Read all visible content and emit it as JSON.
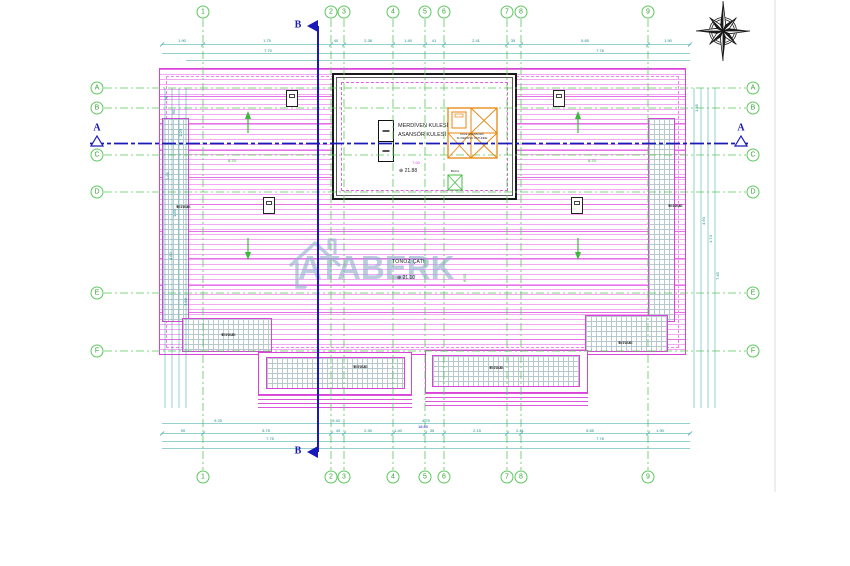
{
  "drawing": {
    "watermark_text": "ATABERK",
    "roof_type_label": "TONOZ ÇATI",
    "roof_level": "21.10",
    "level_symbol": "⊕",
    "tower": {
      "label_line1": "MERDİVEN KULESİ",
      "label_line2": "ASANSÖR KULESİ",
      "level": "21.88",
      "elevator_label_line1": "KULE ASANSÖRÜ",
      "elevator_label_line2": "SU DEPOSU ÜSTÜNDE",
      "shaft_label": "BACA"
    },
    "section_markers": {
      "horizontal": "A",
      "vertical": "B"
    }
  },
  "grid": {
    "columns": [
      {
        "label": "1",
        "x": 203
      },
      {
        "label": "2",
        "x": 331
      },
      {
        "label": "3",
        "x": 344
      },
      {
        "label": "4",
        "x": 393
      },
      {
        "label": "5",
        "x": 425
      },
      {
        "label": "6",
        "x": 444
      },
      {
        "label": "7",
        "x": 507
      },
      {
        "label": "8",
        "x": 521
      },
      {
        "label": "9",
        "x": 648
      }
    ],
    "rows": [
      {
        "label": "A",
        "y": 88
      },
      {
        "label": "B",
        "y": 108
      },
      {
        "label": "C",
        "y": 155
      },
      {
        "label": "D",
        "y": 192
      },
      {
        "label": "E",
        "y": 293
      },
      {
        "label": "F",
        "y": 351
      }
    ]
  },
  "terraces": [
    {
      "label": "TERAS",
      "level": "17.38",
      "x": 176,
      "y": 204
    },
    {
      "label": "TERAS",
      "level": "17.38",
      "x": 668,
      "y": 203
    },
    {
      "label": "TERAS",
      "level": "17.38",
      "x": 221,
      "y": 332
    },
    {
      "label": "TERAS",
      "level": "17.38",
      "x": 618,
      "y": 340
    },
    {
      "label": "TERAS",
      "level": "17.38",
      "x": 353,
      "y": 364
    },
    {
      "label": "TERAS",
      "level": "17.38",
      "x": 489,
      "y": 365
    }
  ],
  "dimensions": {
    "labels": [
      {
        "t": "1.90",
        "x": 182,
        "y": 41
      },
      {
        "t": "1.75",
        "x": 267,
        "y": 41
      },
      {
        "t": "40",
        "x": 336,
        "y": 41
      },
      {
        "t": "2.38",
        "x": 368,
        "y": 41
      },
      {
        "t": "1.40",
        "x": 408,
        "y": 41
      },
      {
        "t": "41",
        "x": 434,
        "y": 41
      },
      {
        "t": "2.41",
        "x": 476,
        "y": 41
      },
      {
        "t": "35",
        "x": 513,
        "y": 41
      },
      {
        "t": "5.65",
        "x": 585,
        "y": 41
      },
      {
        "t": "1.90",
        "x": 668,
        "y": 41
      },
      {
        "t": "7.70",
        "x": 268,
        "y": 51
      },
      {
        "t": "7.76",
        "x": 600,
        "y": 51
      },
      {
        "t": "9.25",
        "x": 218,
        "y": 421
      },
      {
        "t": "9.40",
        "x": 336,
        "y": 421
      },
      {
        "t": "4.75",
        "x": 426,
        "y": 421
      },
      {
        "t": "90",
        "x": 183,
        "y": 431
      },
      {
        "t": "5.75",
        "x": 266,
        "y": 431
      },
      {
        "t": "40",
        "x": 338,
        "y": 431
      },
      {
        "t": "2.30",
        "x": 368,
        "y": 431
      },
      {
        "t": "1.40",
        "x": 398,
        "y": 431
      },
      {
        "t": "35",
        "x": 432,
        "y": 431
      },
      {
        "t": "2.15",
        "x": 477,
        "y": 431
      },
      {
        "t": "2.41",
        "x": 520,
        "y": 431
      },
      {
        "t": "5.65",
        "x": 590,
        "y": 431
      },
      {
        "t": "1.90",
        "x": 660,
        "y": 431
      },
      {
        "t": "7.75",
        "x": 270,
        "y": 439
      },
      {
        "t": "7.76",
        "x": 600,
        "y": 439
      },
      {
        "t": "18.60",
        "x": 423,
        "y": 427,
        "c": "blu"
      },
      {
        "t": "75",
        "x": 167,
        "y": 98,
        "c": "rot"
      },
      {
        "t": "90",
        "x": 174,
        "y": 112,
        "c": "rot"
      },
      {
        "t": "1.20",
        "x": 181,
        "y": 133,
        "c": "rot"
      },
      {
        "t": "1.65",
        "x": 168,
        "y": 176,
        "c": "rot"
      },
      {
        "t": "1.85",
        "x": 175,
        "y": 213,
        "c": "rot"
      },
      {
        "t": "4.60",
        "x": 171,
        "y": 256,
        "c": "rot"
      },
      {
        "t": "7.60",
        "x": 186,
        "y": 302,
        "c": "rot"
      },
      {
        "t": "1.35",
        "x": 697,
        "y": 108,
        "c": "rot"
      },
      {
        "t": "4.60",
        "x": 704,
        "y": 221,
        "c": "rot"
      },
      {
        "t": "1.74",
        "x": 711,
        "y": 239,
        "c": "rot"
      },
      {
        "t": "7.45",
        "x": 718,
        "y": 276,
        "c": "rot"
      },
      {
        "t": "7.00",
        "x": 416,
        "y": 163,
        "c": "mag"
      },
      {
        "t": "8.70",
        "x": 232,
        "y": 161,
        "c": "grn"
      },
      {
        "t": "8.70",
        "x": 592,
        "y": 161,
        "c": "grn"
      },
      {
        "t": "6.50",
        "x": 465,
        "y": 278,
        "c": "grnrot"
      }
    ]
  },
  "colors": {
    "roof_line_magenta": "#E95CE9",
    "grid_green": "#5BC85B",
    "dimension_teal": "#2FA3A3",
    "section_blue": "#1A1AB8",
    "elevator_orange": "#E8860F",
    "watermark_blue": "#8FB0CC"
  }
}
